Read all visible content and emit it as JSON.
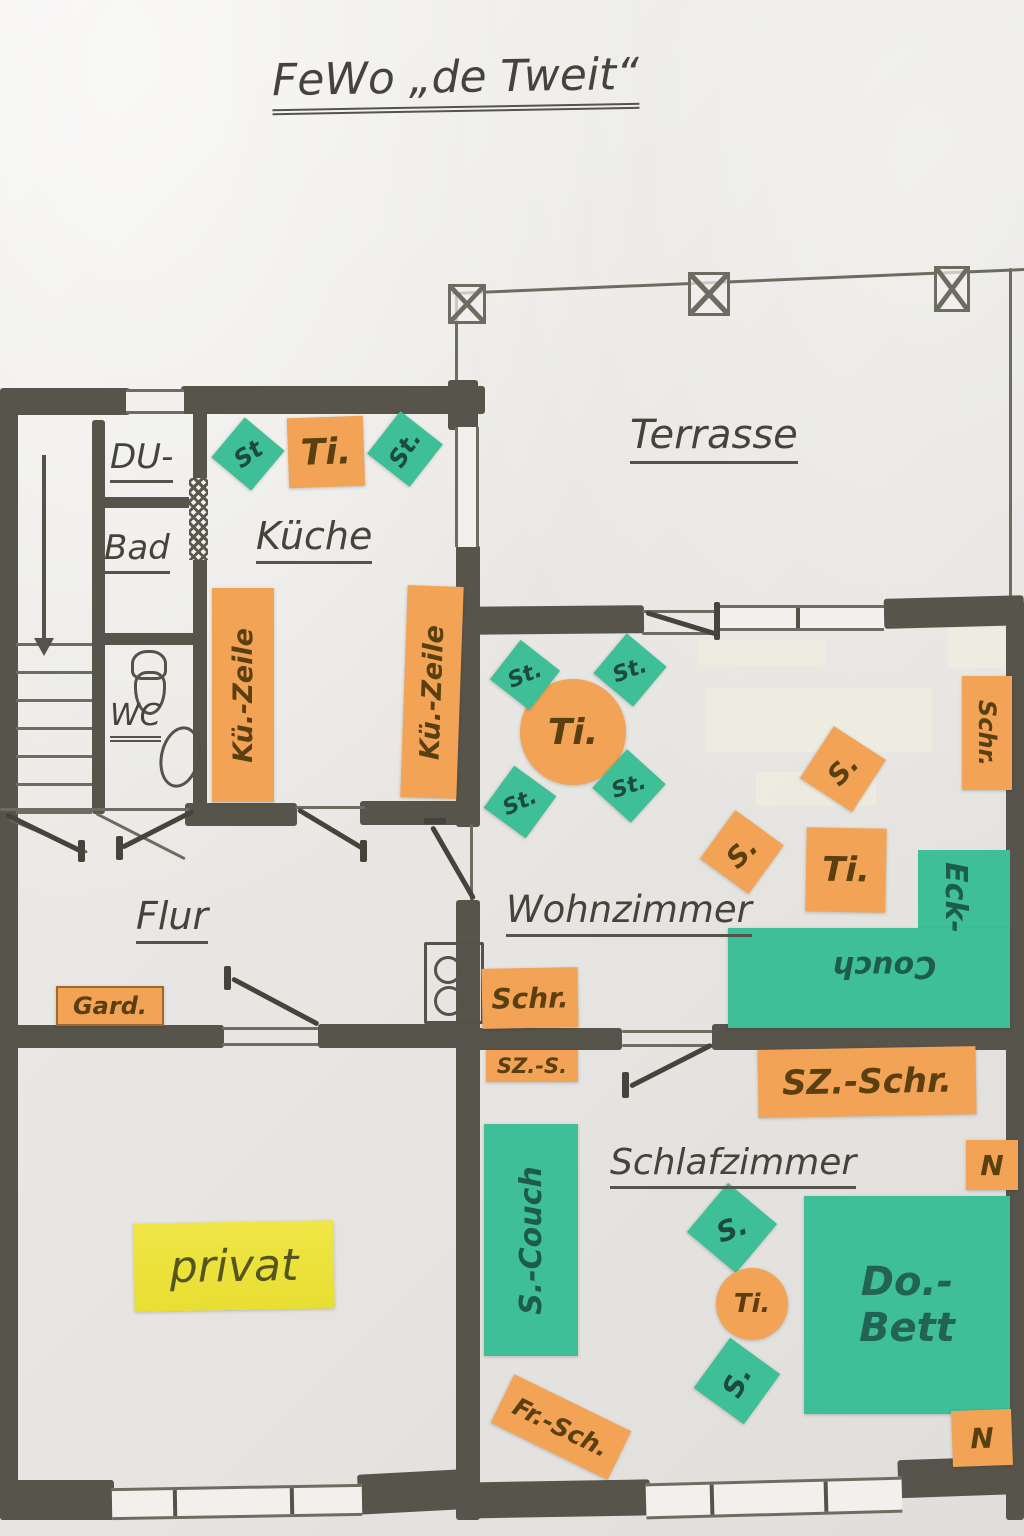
{
  "palette": {
    "cutout_orange": "#f2a355",
    "cutout_teal": "#3ebf97",
    "cutout_yellow": "#eee33e",
    "wall_pencil": "#57544b",
    "text_pencil": "#45433b"
  },
  "title": "FeWo „de Tweit“",
  "rooms": {
    "terrasse": "Terrasse",
    "kueche": "Küche",
    "du": "DU-",
    "bad": "Bad",
    "wc": "WC",
    "flur": "Flur",
    "wohnzimmer": "Wohnzimmer",
    "schlafzimmer": "Schlafzimmer",
    "privat": "privat"
  },
  "furniture": {
    "kueche_chair_left": "St",
    "kueche_table": "Ti.",
    "kueche_chair_right": "St.",
    "kueche_counter_left": "Kü.-Zeile",
    "kueche_counter_right": "Kü.-Zeile",
    "wz_table": "Ti.",
    "wz_chair_tl": "St.",
    "wz_chair_tr": "St.",
    "wz_chair_bl": "St.",
    "wz_chair_br": "St.",
    "wz_schrank_rechts": "Schr.",
    "wz_sessel_1": "S.",
    "wz_sessel_2": "S.",
    "wz_beistelltisch": "Ti.",
    "wz_eckcouch_1": "Eck-",
    "wz_eckcouch_2": "Couch",
    "wz_schrank_links": "Schr.",
    "flur_garderobe": "Gard.",
    "sz_schrank_klein": "SZ.-S.",
    "sz_schrank": "SZ.-Schr.",
    "sz_nachttisch_oben": "N",
    "sz_nachttisch_unten": "N",
    "sz_bett_1": "Do.-",
    "sz_bett_2": "Bett",
    "sz_couch": "S.-Couch",
    "sz_sessel_1": "S.",
    "sz_sessel_2": "S.",
    "sz_tisch": "Ti.",
    "sz_frisierschrank": "Fr.-Sch."
  }
}
